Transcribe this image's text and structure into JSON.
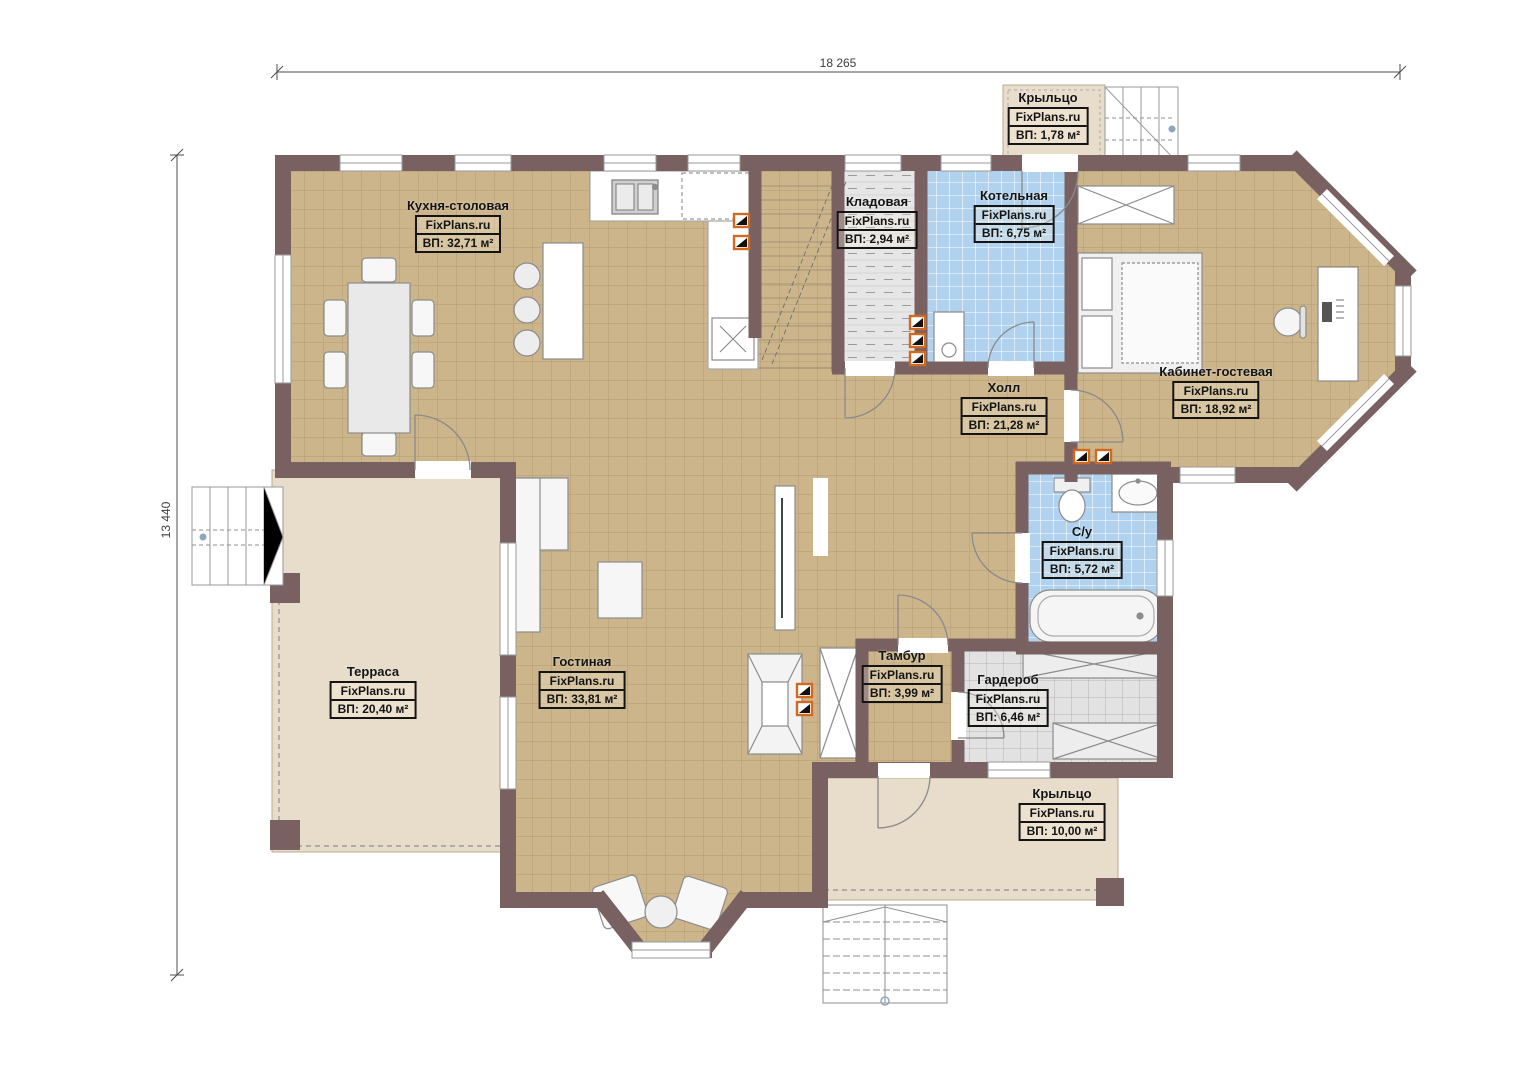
{
  "brand": "FixPlans.ru",
  "dimensions": {
    "width_label": "18 265",
    "height_label": "13 440"
  },
  "rooms": [
    {
      "key": "porch-top",
      "name": "Крыльцо",
      "site": "FixPlans.ru",
      "area": "ВП: 1,78 м²"
    },
    {
      "key": "kitchen",
      "name": "Кухня-столовая",
      "site": "FixPlans.ru",
      "area": "ВП: 32,71 м²"
    },
    {
      "key": "pantry",
      "name": "Кладовая",
      "site": "FixPlans.ru",
      "area": "ВП: 2,94 м²"
    },
    {
      "key": "boiler",
      "name": "Котельная",
      "site": "FixPlans.ru",
      "area": "ВП: 6,75 м²"
    },
    {
      "key": "study-guest",
      "name": "Кабинет-гостевая",
      "site": "FixPlans.ru",
      "area": "ВП: 18,92 м²"
    },
    {
      "key": "hall",
      "name": "Холл",
      "site": "FixPlans.ru",
      "area": "ВП: 21,28 м²"
    },
    {
      "key": "bathroom",
      "name": "С/у",
      "site": "FixPlans.ru",
      "area": "ВП: 5,72 м²"
    },
    {
      "key": "terrace",
      "name": "Терраса",
      "site": "FixPlans.ru",
      "area": "ВП: 20,40 м²"
    },
    {
      "key": "living",
      "name": "Гостиная",
      "site": "FixPlans.ru",
      "area": "ВП: 33,81 м²"
    },
    {
      "key": "vestibule",
      "name": "Тамбур",
      "site": "FixPlans.ru",
      "area": "ВП: 3,99 м²"
    },
    {
      "key": "wardrobe",
      "name": "Гардероб",
      "site": "FixPlans.ru",
      "area": "ВП: 6,46 м²"
    },
    {
      "key": "porch-bottom",
      "name": "Крыльцо",
      "site": "FixPlans.ru",
      "area": "ВП: 10,00 м²"
    }
  ],
  "colors": {
    "wall": "#7a6161",
    "floor_tile": "#cdb58b",
    "wet_tile": "#b0d2ee",
    "storage_floor": "#e4e4e4",
    "outdoor_floor": "#e8ddca",
    "vent_accent": "#cf6a1f"
  }
}
